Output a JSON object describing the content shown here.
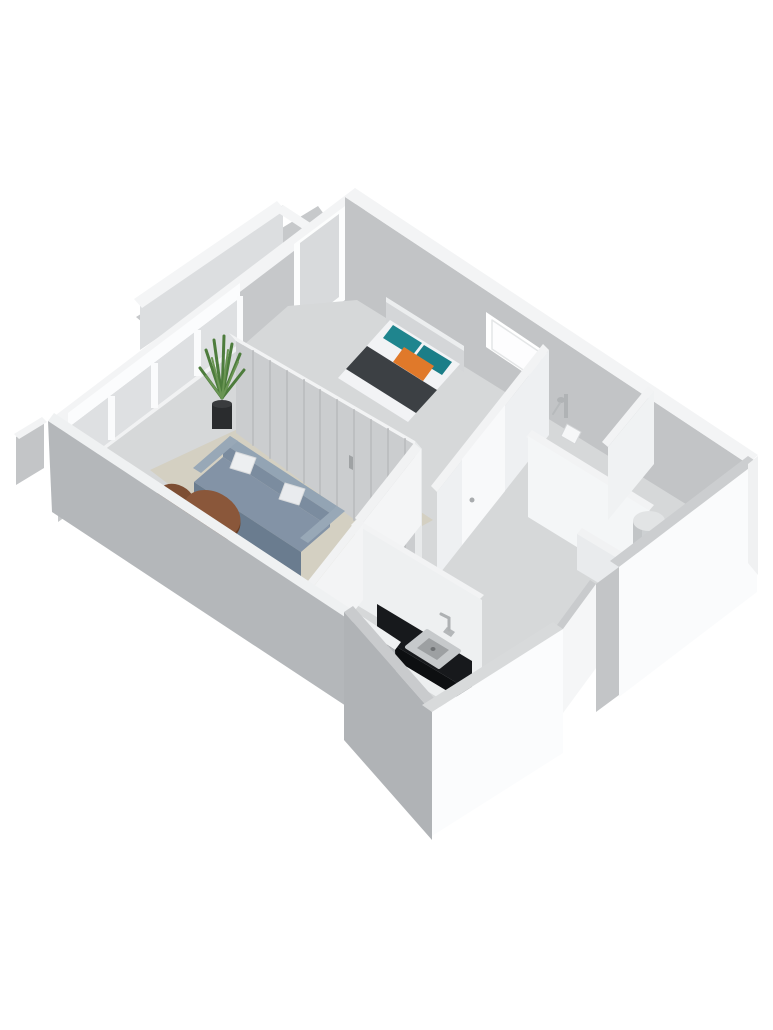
{
  "scene": {
    "description": "3D isometric dollhouse-style floor plan render of a small one-bedroom apartment, no text labels",
    "background": "#ffffff",
    "palette": {
      "exterior_wall_gray": "#c2c4c6",
      "near_wall_gray": "#b4b7ba",
      "wall_top_white": "#f3f4f5",
      "floor_gray": "#d6d8d9",
      "rug_beige": "#d4d0c2",
      "sofa_blue_gray": "#8393a6",
      "table_wood_brown": "#8a573a",
      "bed_runner_dark": "#3c4044",
      "pillow_teal": "#1f858e",
      "pillow_orange": "#e0792a",
      "kitchen_counter_black": "#17191c",
      "plant_green": "#4d7c3c",
      "fixture_white": "#f6f7f8"
    },
    "objects": [
      "balcony-with-railing",
      "living-room-window-wall",
      "bedroom-balcony-door",
      "bathroom-window",
      "living-room-rug",
      "sofa-with-two-pillows",
      "two-round-coffee-tables",
      "potted-plant",
      "closet-wall-with-slatted-doors",
      "double-bed-with-teal-and-orange-pillows",
      "hallway-doors",
      "bathroom-shower-fixture",
      "bathroom-hand-basin",
      "kitchen-counter-with-sink-and-faucet",
      "utility-room-boiler-cylinder",
      "white-cutaway-front-walls"
    ],
    "shapes": [
      {
        "t": "p",
        "name": "balcony-floor",
        "fill": "#c7c9cb",
        "pts": "318,206 136,317 190,362 352,252"
      },
      {
        "t": "p",
        "name": "balcony-railing-face",
        "fill": "#dcdee0",
        "pts": "140,303 283,205 283,252 140,350"
      },
      {
        "t": "p",
        "name": "balcony-railing-top",
        "fill": "#f4f5f6",
        "pts": "277,201 134,299 142,308 285,210"
      },
      {
        "t": "p",
        "name": "balcony-railing-return-top",
        "fill": "#f4f5f6",
        "pts": "283,205 312,224 306,231 277,212"
      },
      {
        "t": "p",
        "name": "balcony-stub-face",
        "fill": "#c3c5c7",
        "pts": "16,437 44,420 44,468 16,485"
      },
      {
        "t": "p",
        "name": "balcony-stub-top",
        "fill": "#f2f3f4",
        "pts": "14,434 42,417 47,422 19,439"
      },
      {
        "t": "p",
        "name": "top-left-wall-face",
        "fill": "#c6c8ca",
        "pts": "365,197 58,430 58,522 365,302"
      },
      {
        "t": "p",
        "name": "top-left-wall-top",
        "fill": "#f3f4f5",
        "pts": "355,188 48,421 58,430 365,197"
      },
      {
        "t": "p",
        "name": "bedroom-balcony-door-frame",
        "fill": "#fcfdfd",
        "pts": "345,206 294,244 294,338 345,300"
      },
      {
        "t": "p",
        "name": "bedroom-balcony-door-glass",
        "fill": "#d8dadc",
        "pts": "339,214 300,243 300,327 339,297"
      },
      {
        "t": "p",
        "name": "living-window-beam",
        "fill": "#fbfcfd",
        "pts": "240,283 68,413 68,428 240,298"
      },
      {
        "t": "p",
        "name": "living-window-glass",
        "fill": "#dee0e2",
        "pts": "240,298 68,428 68,473 240,343"
      },
      {
        "t": "p",
        "name": "living-window-sill",
        "fill": "#f1f2f3",
        "pts": "240,343 68,473 68,503 240,373"
      },
      {
        "t": "p",
        "name": "living-window-post-1",
        "fill": "#fafbfc",
        "pts": "237,296 243,296 243,345 237,345"
      },
      {
        "t": "p",
        "name": "living-window-post-2",
        "fill": "#fafbfc",
        "pts": "194,330 201,330 201,376 194,376"
      },
      {
        "t": "p",
        "name": "living-window-post-3",
        "fill": "#fafbfc",
        "pts": "151,363 158,363 158,408 151,408"
      },
      {
        "t": "p",
        "name": "living-window-post-4",
        "fill": "#fafbfc",
        "pts": "108,396 115,396 115,440 108,440"
      },
      {
        "t": "p",
        "name": "top-right-wall-face",
        "fill": "#c2c4c6",
        "pts": "345,197 748,464 748,540 345,309"
      },
      {
        "t": "p",
        "name": "top-right-wall-top",
        "fill": "#f3f4f5",
        "pts": "355,188 758,455 748,464 345,197"
      },
      {
        "t": "p",
        "name": "bathroom-window-frame",
        "fill": "#ffffff",
        "pts": "486,312 547,353 547,388 486,347"
      },
      {
        "t": "p",
        "name": "bathroom-window-glass",
        "fill": "#fdfdfe",
        "stroke": "#e4e6e7",
        "sw": 1.5,
        "pts": "492,320 541,353 541,382 492,349"
      },
      {
        "t": "p",
        "name": "floor-main",
        "fill": "#d6d8d9",
        "pts": "357,300 747,542 618,642 556,650 448,714 346,626 88,462 238,350 288,306"
      },
      {
        "t": "p",
        "name": "living-room-rug",
        "fill": "#d4d0c2",
        "pts": "150,470 272,413 433,520 306,590"
      },
      {
        "t": "p",
        "name": "closet-wall-top",
        "fill": "#f2f3f4",
        "pts": "229,333 415,441 422,449 236,341"
      },
      {
        "t": "p",
        "name": "closet-wall-face",
        "fill": "#cbcdcf",
        "pts": "236,341 422,449 422,569 236,433"
      },
      {
        "t": "l",
        "name": "closet-door-slats",
        "stroke": "#bdbfc1",
        "sw": 2,
        "segs": [
          [
            253,
            351,
            253,
            445
          ],
          [
            270,
            361,
            270,
            458
          ],
          [
            287,
            371,
            287,
            470
          ],
          [
            304,
            380,
            304,
            483
          ],
          [
            320,
            390,
            320,
            495
          ],
          [
            337,
            400,
            337,
            507
          ],
          [
            354,
            410,
            354,
            520
          ],
          [
            371,
            420,
            371,
            532
          ],
          [
            388,
            429,
            388,
            544
          ],
          [
            405,
            439,
            405,
            557
          ]
        ]
      },
      {
        "t": "p",
        "name": "closet-wall-endcap",
        "fill": "#e8eaeb",
        "pts": "415,441 422,449 422,569 415,561"
      },
      {
        "t": "p",
        "name": "closet-door-handle",
        "fill": "#9fa2a4",
        "pts": "349,455 353,457 353,470 349,468"
      },
      {
        "t": "p",
        "name": "bed-headboard",
        "fill": "#d4d6d8",
        "pts": "386,297 464,346 464,372 386,323"
      },
      {
        "t": "p",
        "name": "bed-headboard-top",
        "fill": "#eceeef",
        "pts": "386,297 464,346 464,351 386,302"
      },
      {
        "t": "p",
        "name": "bed-mattress",
        "fill": "#f2f3f5",
        "pts": "390,320 460,364 408,422 338,378"
      },
      {
        "t": "p",
        "name": "bed-runner-blanket",
        "fill": "#3c4044",
        "pts": "367,346 437,390 416,413 346,369"
      },
      {
        "t": "p",
        "name": "bed-pillow-teal-left",
        "fill": "#1f858e",
        "pts": "393,325 422,343 412,356 383,338"
      },
      {
        "t": "p",
        "name": "bed-pillow-teal-right",
        "fill": "#1b7e88",
        "pts": "424,345 452,362 442,375 414,358"
      },
      {
        "t": "p",
        "name": "bed-pillow-orange",
        "fill": "#e0792a",
        "pts": "404,347 434,366 423,381 393,362"
      },
      {
        "t": "p",
        "name": "plant-pot",
        "fill": "#2a2c2e",
        "pts": "212,404 232,404 232,429 212,429"
      },
      {
        "t": "e",
        "name": "plant-pot-top",
        "fill": "#3a3c3e",
        "cx": 222,
        "cy": 404,
        "rx": 10,
        "ry": 4
      },
      {
        "t": "l",
        "name": "plant-leaves-dark",
        "stroke": "#4d7c3c",
        "sw": 3,
        "segs": [
          [
            222,
            398,
            206,
            350
          ],
          [
            222,
            398,
            214,
            340
          ],
          [
            222,
            398,
            224,
            336
          ],
          [
            222,
            398,
            232,
            344
          ],
          [
            222,
            398,
            240,
            354
          ],
          [
            222,
            398,
            200,
            368
          ],
          [
            222,
            398,
            244,
            370
          ]
        ]
      },
      {
        "t": "l",
        "name": "plant-leaves-light",
        "stroke": "#6a9553",
        "sw": 2,
        "segs": [
          [
            222,
            398,
            212,
            358
          ],
          [
            222,
            398,
            228,
            350
          ],
          [
            222,
            398,
            238,
            362
          ],
          [
            222,
            398,
            206,
            376
          ]
        ]
      },
      {
        "t": "p",
        "name": "sofa-back-top",
        "fill": "#93a4b4",
        "pts": "230,436 337,506 330,513 223,443"
      },
      {
        "t": "p",
        "name": "sofa-back-face",
        "fill": "#7b8c9f",
        "pts": "223,443 330,513 330,527 223,457"
      },
      {
        "t": "p",
        "name": "sofa-seat",
        "fill": "#8393a6",
        "pts": "223,457 330,527 301,552 194,482"
      },
      {
        "t": "p",
        "name": "sofa-front-face",
        "fill": "#6a7c8f",
        "pts": "194,482 301,552 301,576 194,506"
      },
      {
        "t": "p",
        "name": "sofa-arm-left",
        "fill": "#98a8b7",
        "pts": "230,436 238,441 201,473 193,468"
      },
      {
        "t": "p",
        "name": "sofa-arm-right",
        "fill": "#98a8b7",
        "pts": "337,506 345,511 308,543 300,538"
      },
      {
        "t": "p",
        "name": "sofa-pillow-left",
        "fill": "#edeff1",
        "stroke": "#d9dbdd",
        "sw": 1,
        "pts": "236,452 256,458 250,474 230,468"
      },
      {
        "t": "p",
        "name": "sofa-pillow-right",
        "fill": "#e9ebee",
        "stroke": "#d9dbdd",
        "sw": 1,
        "pts": "285,483 305,489 299,505 279,499"
      },
      {
        "t": "e",
        "name": "coffee-table-small-rim",
        "fill": "#5f3822",
        "cx": 176,
        "cy": 503,
        "rx": 20,
        "ry": 15,
        "rot": 28
      },
      {
        "t": "e",
        "name": "coffee-table-small",
        "fill": "#7d4e33",
        "cx": 176,
        "cy": 500,
        "rx": 20,
        "ry": 15,
        "rot": 28
      },
      {
        "t": "e",
        "name": "coffee-table-big-rim",
        "fill": "#693e24",
        "cx": 212,
        "cy": 517,
        "rx": 30,
        "ry": 22,
        "rot": 28
      },
      {
        "t": "e",
        "name": "coffee-table-big",
        "fill": "#8a573a",
        "cx": 212,
        "cy": 514,
        "rx": 30,
        "ry": 22,
        "rot": 28
      },
      {
        "t": "l",
        "name": "coffee-table-legs",
        "stroke": "#5a5a5a",
        "sw": 2,
        "segs": [
          [
            196,
            540,
            199,
            551
          ],
          [
            216,
            536,
            219,
            547
          ]
        ]
      },
      {
        "t": "p",
        "name": "entry-threshold",
        "fill": "#f4f5f6",
        "pts": "252,567 281,585 269,597 240,579"
      },
      {
        "t": "p",
        "name": "hall-living-wall-top",
        "fill": "#f1f2f3",
        "pts": "414,443 355,518 362,524 421,449"
      },
      {
        "t": "p",
        "name": "hall-living-wall-face",
        "fill": "#f4f5f6",
        "pts": "421,449 362,524 362,600 421,525"
      },
      {
        "t": "p",
        "name": "bathroom-door-wall-top",
        "fill": "#f2f3f4",
        "pts": "543,344 431,486 437,492 549,350"
      },
      {
        "t": "p",
        "name": "bathroom-door-wall-face",
        "fill": "#eef0f2",
        "pts": "549,350 437,492 437,577 549,435"
      },
      {
        "t": "p",
        "name": "bathroom-door",
        "fill": "#f8f9fa",
        "pts": "505,405 462,459 462,545 505,491"
      },
      {
        "t": "e",
        "name": "bathroom-door-handle",
        "fill": "#a9acae",
        "cx": 472,
        "cy": 500,
        "rx": 2.5,
        "ry": 2.5
      },
      {
        "t": "p",
        "name": "bath-utility-wall-top",
        "fill": "#f2f3f4",
        "pts": "532,430 654,505 648,512 526,437"
      },
      {
        "t": "p",
        "name": "bath-utility-wall-face",
        "fill": "#f4f6f7",
        "pts": "528,436 650,511 650,592 528,517"
      },
      {
        "t": "p",
        "name": "bath-stub-wall-top",
        "fill": "#f2f3f4",
        "pts": "648,386 602,442 608,447 654,391"
      },
      {
        "t": "p",
        "name": "bath-stub-wall-face",
        "fill": "#f0f2f3",
        "pts": "654,391 608,447 608,520 654,464"
      },
      {
        "t": "p",
        "name": "utility-nook-wall-top",
        "fill": "#f1f2f3",
        "pts": "582,528 632,558 627,564 577,534"
      },
      {
        "t": "p",
        "name": "utility-nook-wall-face",
        "fill": "#e9ebed",
        "pts": "577,534 627,564 627,600 577,570"
      },
      {
        "t": "p",
        "name": "kitchen-hall-wall-top",
        "fill": "#f2f3f4",
        "pts": "357,519 484,595 478,601 351,525"
      },
      {
        "t": "p",
        "name": "kitchen-hall-wall-face",
        "fill": "#eef0f1",
        "pts": "355,524 482,600 482,680 355,604"
      },
      {
        "t": "p",
        "name": "kitchen-living-wall-top",
        "fill": "#f1f2f3",
        "pts": "304,586 357,519 363,524 310,591"
      },
      {
        "t": "p",
        "name": "kitchen-living-wall-face",
        "fill": "#f3f4f5",
        "pts": "310,591 363,524 363,600 310,667"
      },
      {
        "t": "p",
        "name": "kitchen-counter-top",
        "fill": "#17191c",
        "pts": "377,604 472,661 472,692 377,635"
      },
      {
        "t": "p",
        "name": "kitchen-counter-front",
        "fill": "#0d0f11",
        "pts": "377,635 472,692 472,706 377,649"
      },
      {
        "t": "p",
        "name": "kitchen-counter-base",
        "fill": "#edeff0",
        "pts": "377,649 472,706 472,718 377,661"
      },
      {
        "t": "p",
        "name": "kitchen-sink-outer",
        "fill": "#c6c9cb",
        "stroke": "#c6c9cb",
        "sw": 4,
        "pts": "427,631 459,651 439,667 407,647"
      },
      {
        "t": "p",
        "name": "kitchen-sink-basin",
        "fill": "#9da0a2",
        "pts": "429,638 449,650 437,660 417,648"
      },
      {
        "t": "e",
        "name": "kitchen-sink-drain",
        "fill": "#6f7274",
        "cx": 433,
        "cy": 649,
        "rx": 2.5,
        "ry": 2
      },
      {
        "t": "p",
        "name": "kitchen-faucet-base",
        "fill": "#b4b7b9",
        "pts": "447,627 455,632 451,637 443,632"
      },
      {
        "t": "l",
        "name": "kitchen-faucet-neck",
        "stroke": "#aeb1b3",
        "sw": 3,
        "segs": [
          [
            449,
            630,
            449,
            618
          ],
          [
            449,
            618,
            441,
            614
          ]
        ]
      },
      {
        "t": "p",
        "name": "boiler-cylinder-body",
        "fill": "#cdd0d2",
        "pts": "633,521 665,521 665,553 633,553"
      },
      {
        "t": "p",
        "name": "boiler-cylinder-shade",
        "fill": "#c2c5c7",
        "pts": "633,521 642,521 642,553 633,553"
      },
      {
        "t": "e",
        "name": "boiler-cylinder-top",
        "fill": "#e2e4e5",
        "cx": 649,
        "cy": 521,
        "rx": 16,
        "ry": 10
      },
      {
        "t": "p",
        "name": "shower-bar",
        "fill": "#b0b3b5",
        "pts": "564,394 568,394 568,418 564,418"
      },
      {
        "t": "e",
        "name": "shower-head",
        "fill": "#b0b3b5",
        "cx": 561,
        "cy": 400,
        "rx": 4,
        "ry": 3
      },
      {
        "t": "l",
        "name": "shower-hose",
        "stroke": "#b7babc",
        "sw": 2,
        "segs": [
          [
            560,
            403,
            553,
            414
          ]
        ]
      },
      {
        "t": "p",
        "name": "bathroom-hand-basin",
        "fill": "#f6f7f8",
        "stroke": "#d4d6d8",
        "sw": 1,
        "pts": "567,424 581,432 575,444 561,436"
      },
      {
        "t": "p",
        "name": "bottom-left-wall-topstrip",
        "fill": "#eff1f2",
        "pts": "54,413 401,642 395,650 48,421"
      },
      {
        "t": "p",
        "name": "bottom-left-wall-band",
        "fill": "#b4b7ba",
        "pts": "48,421 395,650 399,741 52,512"
      },
      {
        "t": "p",
        "name": "kitchen-block-left-top",
        "fill": "#c9cbcd",
        "pts": "344,612 432,712 441,706 353,606"
      },
      {
        "t": "p",
        "name": "kitchen-block-left-face",
        "fill": "#b0b3b6",
        "pts": "344,612 432,712 432,840 344,740"
      },
      {
        "t": "p",
        "name": "kitchen-block-front-top",
        "fill": "#d8dadb",
        "pts": "432,712 563,629 553,622 422,705"
      },
      {
        "t": "p",
        "name": "kitchen-block-front-face",
        "fill": "#fbfcfd",
        "pts": "432,712 563,629 563,753 432,836"
      },
      {
        "t": "p",
        "name": "gap-wall-top",
        "fill": "#c9cbcd",
        "pts": "563,629 596,584 590,580 557,625"
      },
      {
        "t": "p",
        "name": "gap-wall-face",
        "fill": "#f5f6f7",
        "pts": "563,629 596,584 596,668 563,713"
      },
      {
        "t": "p",
        "name": "utility-left-sliver",
        "fill": "#c3c5c7",
        "pts": "596,584 619,567 619,695 596,712"
      },
      {
        "t": "p",
        "name": "utility-front-top",
        "fill": "#ccced0",
        "pts": "619,567 757,462 748,456 610,561"
      },
      {
        "t": "p",
        "name": "utility-front-face",
        "fill": "#fafbfc",
        "pts": "619,567 757,462 757,592 619,697"
      },
      {
        "t": "p",
        "name": "right-corner-cap",
        "fill": "#f0f1f2",
        "pts": "748,464 758,456 758,575 748,563"
      }
    ]
  }
}
